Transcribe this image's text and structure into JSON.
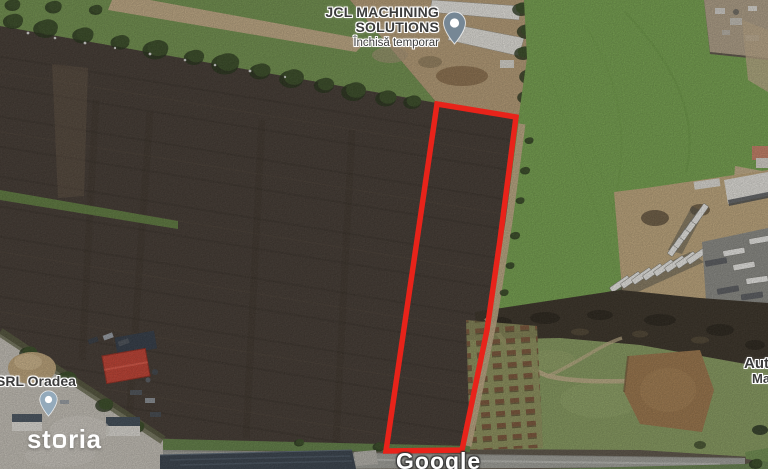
{
  "map": {
    "provider": "Google",
    "view": "satellite"
  },
  "labels": {
    "business": {
      "name_line1": "JCL MACHINING",
      "name_line2": "SOLUTIONS",
      "status": "Închisă temporar"
    },
    "company": {
      "name": "SRL Oradea"
    },
    "right_edge": {
      "line1": "Aut",
      "line2": "Ma"
    }
  },
  "watermarks": {
    "storia_prefix": "st",
    "storia_suffix": "ria",
    "storia_full": "storia",
    "google": "Google"
  },
  "overlay": {
    "plot_outline_color": "#e8231a",
    "plot_points": "437,104 516,117 500,240 487,330 462,450 386,451"
  },
  "icons": {
    "business_pin": "map-pin-icon",
    "company_pin": "map-pin-icon"
  },
  "colors": {
    "plot-red": "#e8231a",
    "pin-dark": "#768795",
    "pin-light": "#94aabb",
    "label-text": "#3c3c3c",
    "field-dark": "#3e342c",
    "grass-bright": "#74a34a",
    "band-top-grass": "#6f9149",
    "yard-tan": "#c2a87b",
    "road-gray": "#a2a29b",
    "concrete": "#c9c4ba",
    "roof-red": "#c43b2b"
  }
}
